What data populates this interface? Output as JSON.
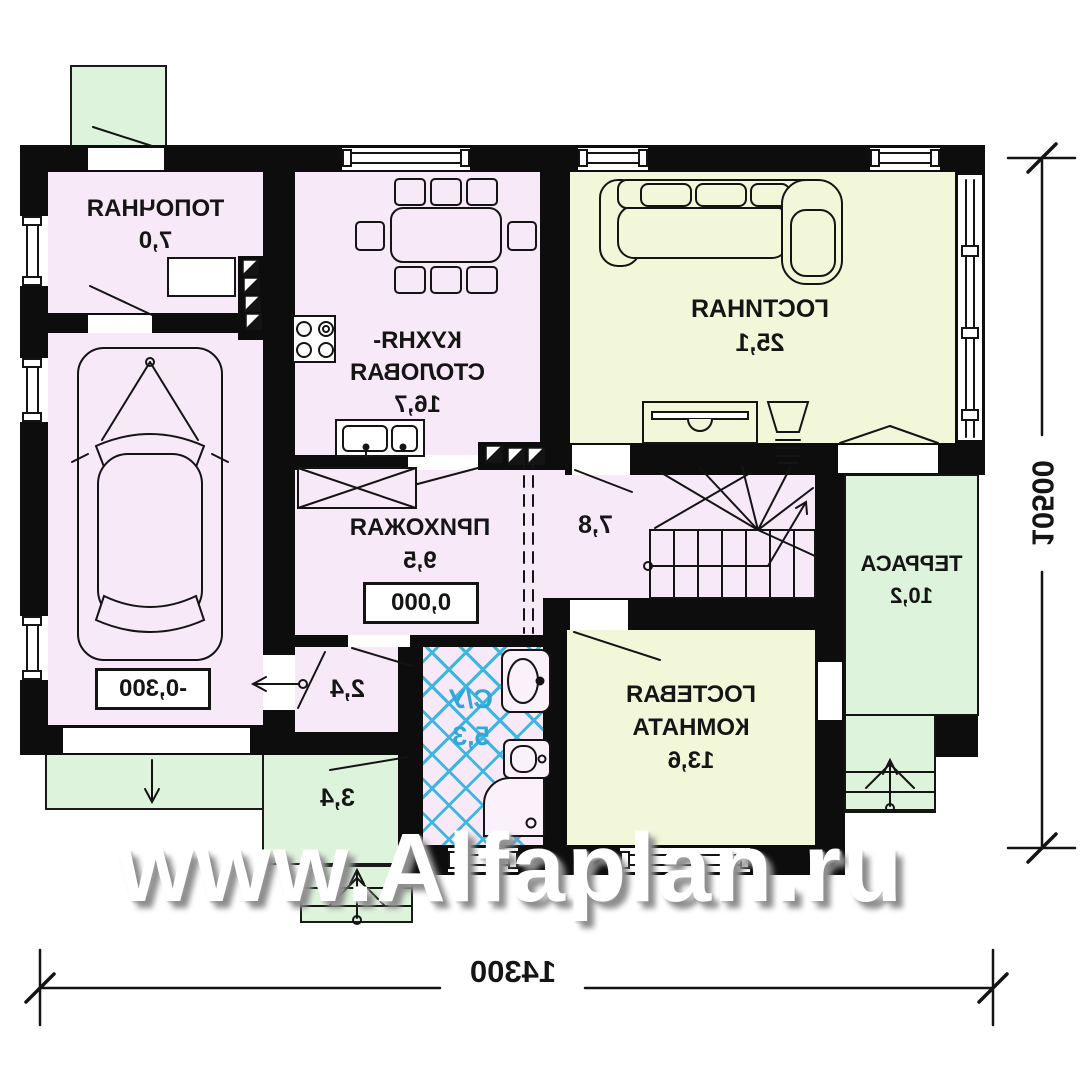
{
  "watermark": "www.Alfaplan.ru",
  "rooms": {
    "boiler": {
      "name": "ТОПОЧНАЯ",
      "area": "7,0"
    },
    "kitchen": {
      "name_line1": "КУХНЯ-",
      "name_line2": "СТОЛОВАЯ",
      "area": "16,7"
    },
    "living": {
      "name": "ГОСТИНАЯ",
      "area": "25,1"
    },
    "garage": {
      "name": "ГАРАЖ",
      "area": "21,3",
      "level_mark": "-0,300"
    },
    "hallway": {
      "name": "ПРИХОЖАЯ",
      "area": "9,5",
      "level_mark": "0,000"
    },
    "stair_hall": {
      "area": "7,8"
    },
    "bathroom": {
      "name": "С/У",
      "area": "5,3"
    },
    "vestibule": {
      "area": "2,4"
    },
    "entry_porch": {
      "area": "3,4"
    },
    "guest": {
      "name_line1": "ГОСТЕВАЯ",
      "name_line2": "КОМНАТА",
      "area": "13,6"
    },
    "terrace": {
      "name": "ТЕРРАСА",
      "area": "10,2"
    }
  },
  "dimensions": {
    "overall_width": "14300",
    "overall_height": "10500"
  },
  "colors": {
    "wall": "#0d0d0d",
    "room_pink": "#f7e9f7",
    "room_pale_green": "#f3f7d9",
    "outdoor_green": "#def3dc",
    "bath_tile_blue": "#3fb6e0"
  }
}
